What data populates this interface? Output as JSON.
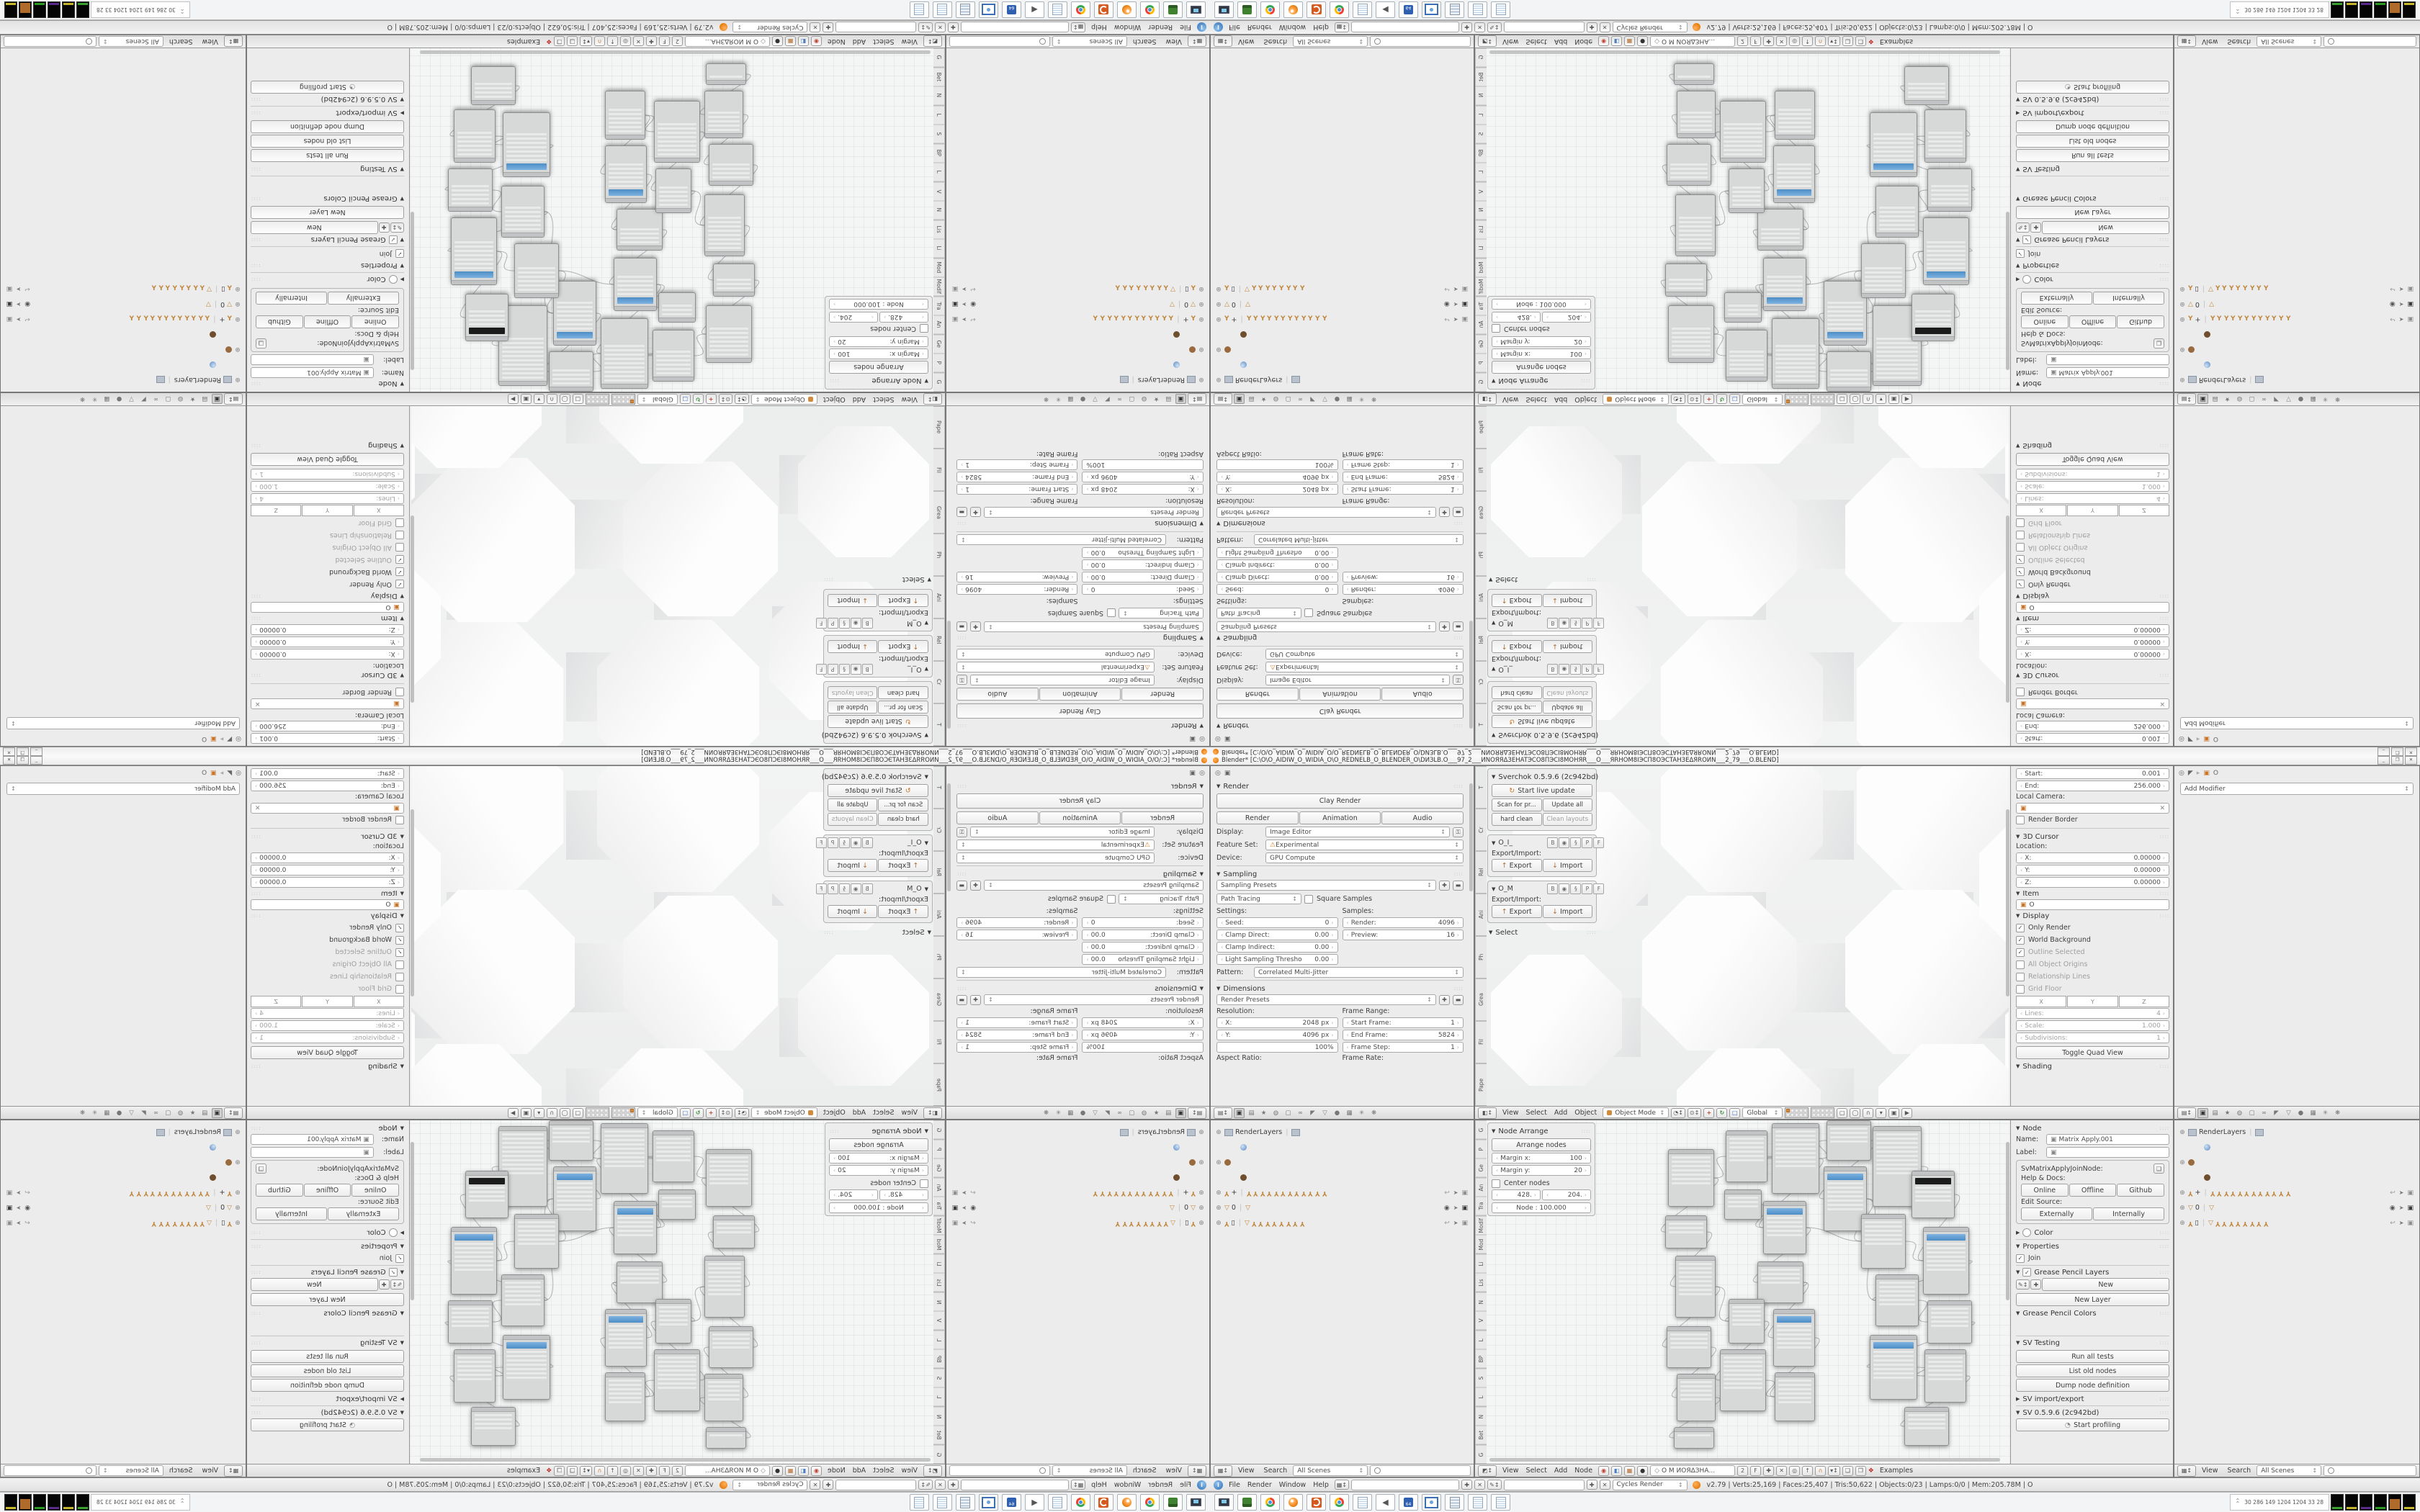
{
  "window": {
    "title": "Blender* [C:\\O\\O_AIDIW_O_WIDIA_O\\O_REDNELB_O_BLENDER_O\\DИЗLB.O___97_2___ИNOЯЯΔЗEHATЭCO8ΠЭCI8MOHЯR___O___ЯRHOM8IЭCΠ8OЭCTAHЗEΔЯROИN___2_79___O.BLEND]",
    "minimize": "_",
    "restore": "❐",
    "close": "✕"
  },
  "props_render": {
    "render_panel": "Render",
    "clay_button": "Clay Render",
    "render_btn": "Render",
    "animation_btn": "Animation",
    "audio_btn": "Audio",
    "display_label": "Display:",
    "display_value": "Image Editor",
    "feature_label": "Feature Set:",
    "feature_value": "Experimental",
    "device_label": "Device:",
    "device_value": "GPU Compute",
    "sampling_panel": "Sampling",
    "sampling_presets": "Sampling Presets",
    "integrator": "Path Tracing",
    "square_samples": "Square Samples",
    "settings_label": "Settings:",
    "samples_label": "Samples:",
    "seed_label": "Seed:",
    "seed_value": "0",
    "clamp_direct_label": "Clamp Direct:",
    "clamp_direct_value": "0.00",
    "clamp_indirect_label": "Clamp Indirect:",
    "clamp_indirect_value": "0.00",
    "light_thresh_label": "Light Sampling Thresho",
    "light_thresh_value": "0.00",
    "samples_render_label": "Render:",
    "samples_render_value": "4096",
    "samples_preview_label": "Preview:",
    "samples_preview_value": "16",
    "pattern_label": "Pattern:",
    "pattern_value": "Correlated Multi-Jitter",
    "dimensions_panel": "Dimensions",
    "render_presets": "Render Presets",
    "resolution_label": "Resolution:",
    "frame_range_label": "Frame Range:",
    "res_x_label": "X:",
    "res_x_value": "2048 px",
    "res_y_label": "Y:",
    "res_y_value": "4096 px",
    "res_pct": "100%",
    "frame_start_label": "Start Frame:",
    "frame_start_value": "1",
    "frame_end_label": "End Frame:",
    "frame_end_value": "5824",
    "frame_step_label": "Frame Step:",
    "frame_step_value": "1",
    "aspect_label": "Aspect Ratio:",
    "rate_label": "Frame Rate:"
  },
  "property_tabs": [
    {
      "name": "render-tab",
      "glyph": "▣",
      "active": true
    },
    {
      "name": "render-layers-tab",
      "glyph": "▤"
    },
    {
      "name": "scene-tab",
      "glyph": "★"
    },
    {
      "name": "world-tab",
      "glyph": "◍"
    },
    {
      "name": "object-tab",
      "glyph": "▢"
    },
    {
      "name": "constraints-tab",
      "glyph": "∞"
    },
    {
      "name": "modifiers-tab",
      "glyph": "◤"
    },
    {
      "name": "data-tab",
      "glyph": "▽"
    },
    {
      "name": "material-tab",
      "glyph": "●"
    },
    {
      "name": "texture-tab",
      "glyph": "▦"
    },
    {
      "name": "particles-tab",
      "glyph": "✳"
    },
    {
      "name": "physics-tab",
      "glyph": "❋"
    }
  ],
  "viewport": {
    "shelf_tabs": [
      "T",
      "Cr",
      "Rel",
      "Ani",
      "Ph",
      "Grea",
      "Fil",
      "Pape"
    ],
    "sverchok": {
      "title": "Sverchok 0.5.9.6 (2c942bd)",
      "start_live": "Start live update",
      "scan": "Scan for pr...",
      "update_all": "Update all",
      "hard_clean": "hard clean",
      "clean_layouts": "Clean layouts",
      "tree1": "O_I_",
      "tree2": "O_M",
      "row_buttons": [
        "B",
        "◉",
        "§",
        "P",
        "F"
      ],
      "export_import": "Export/Import:",
      "export_btn": "Export",
      "import_btn": "Import",
      "select_panel": "Select"
    },
    "npanel": {
      "start_label": "Start:",
      "start_value": "0.001",
      "end_label": "End:",
      "end_value": "256.000",
      "local_camera": "Local Camera:",
      "render_border": "Render Border",
      "cursor_panel": "3D Cursor",
      "location_label": "Location:",
      "x_label": "X:",
      "x_value": "0.00000",
      "y_label": "Y:",
      "y_value": "0.00000",
      "z_label": "Z:",
      "z_value": "0.00000",
      "item_panel": "Item",
      "item_name": "O",
      "display_panel": "Display",
      "checks": [
        {
          "label": "Only Render",
          "checked": true,
          "muted": false
        },
        {
          "label": "World Background",
          "checked": true,
          "muted": false
        },
        {
          "label": "Outline Selected",
          "checked": true,
          "muted": true
        },
        {
          "label": "All Object Origins",
          "checked": false,
          "muted": true
        },
        {
          "label": "Relationship Lines",
          "checked": false,
          "muted": true
        },
        {
          "label": "Grid Floor",
          "checked": false,
          "muted": true
        }
      ],
      "xyz": [
        "X",
        "Y",
        "Z"
      ],
      "lines_label": "Lines:",
      "lines_value": "4",
      "scale_label": "Scale:",
      "scale_value": "1.000",
      "subdiv_label": "Subdivisions:",
      "subdiv_value": "1",
      "toggle_quad": "Toggle Quad View",
      "shading_panel": "Shading"
    },
    "header": {
      "menus": [
        "View",
        "Select",
        "Add",
        "Object"
      ],
      "mode": "Object Mode",
      "orientation": "Global"
    }
  },
  "props_modifier": {
    "object_name": "O",
    "add_modifier": "Add Modifier"
  },
  "outliner": {
    "rows": [
      {
        "name": "renderlayers-row",
        "expand": true,
        "icon": "image",
        "label": "RenderLayers",
        "trail": [
          "image"
        ],
        "right": []
      },
      {
        "name": "world-row",
        "indent": 1,
        "icon": "world",
        "label": "",
        "trail": [],
        "right": []
      },
      {
        "name": "object-row",
        "expand": true,
        "icon": "bear",
        "label": "",
        "trail": [],
        "right": []
      },
      {
        "name": "object-data-row",
        "indent": 1,
        "icon": "bear2",
        "label": "",
        "trail": [],
        "right": []
      },
      {
        "name": "armature-plus-row",
        "expand": true,
        "icon": "arm",
        "label": "+",
        "trail": [
          "arm",
          "arm",
          "arm",
          "arm",
          "arm",
          "arm",
          "arm",
          "arm",
          "arm",
          "arm",
          "arm",
          "arm"
        ],
        "right": [
          "undo",
          "cursor",
          "cam"
        ]
      },
      {
        "name": "cone-zero-row",
        "expand": true,
        "icon": "cone",
        "label": "0",
        "trail": [
          "cone"
        ],
        "right": [
          "eye",
          "cursor",
          "camdark"
        ]
      },
      {
        "name": "armature-box-row",
        "expand": true,
        "icon": "arm",
        "label": "▯",
        "trail": [
          "cone",
          "arm",
          "arm",
          "arm",
          "arm",
          "arm",
          "arm",
          "arm",
          "arm"
        ],
        "right": [
          "undo",
          "cursor",
          "cam"
        ]
      }
    ],
    "header": {
      "view": "View",
      "search": "Search",
      "scenes": "All Scenes"
    }
  },
  "node_editor": {
    "shelf_tabs": [
      "G",
      "P",
      "Ge",
      "An",
      "Tra",
      "Modif",
      "Mod",
      "Li",
      "Lis",
      "N",
      "V",
      "L",
      "BP",
      "S",
      "L",
      "N",
      "Bet",
      "G"
    ],
    "arrange": {
      "panel_title": "Node Arrange",
      "arrange_btn": "Arrange nodes",
      "margin_x_label": "Margin x:",
      "margin_x_value": "100",
      "margin_y_label": "Margin y:",
      "margin_y_value": "20",
      "center_nodes": "Center nodes",
      "field_a": "428.",
      "field_b": "204.",
      "node_scale": "Node : 100.000"
    },
    "header": {
      "menus": [
        "View",
        "Select",
        "Add",
        "Node"
      ],
      "tree_name": "O M ИОЯΔЗНА...",
      "users": "2",
      "fake": "F",
      "examples": "Examples"
    },
    "nodes": [
      [
        268,
        40,
        64,
        80,
        0
      ],
      [
        264,
        132,
        58,
        46,
        0
      ],
      [
        278,
        188,
        56,
        86,
        0
      ],
      [
        266,
        286,
        62,
        58,
        0
      ],
      [
        280,
        352,
        54,
        66,
        0
      ],
      [
        276,
        426,
        56,
        30,
        0
      ],
      [
        348,
        14,
        58,
        72,
        0
      ],
      [
        346,
        96,
        52,
        42,
        0
      ],
      [
        412,
        4,
        66,
        98,
        0
      ],
      [
        400,
        112,
        60,
        74,
        1
      ],
      [
        392,
        196,
        64,
        58,
        0
      ],
      [
        414,
        262,
        58,
        80,
        1
      ],
      [
        352,
        248,
        50,
        62,
        0
      ],
      [
        340,
        318,
        64,
        86,
        0
      ],
      [
        416,
        350,
        56,
        68,
        0
      ],
      [
        488,
        0,
        62,
        56,
        0
      ],
      [
        484,
        64,
        60,
        90,
        1
      ],
      [
        552,
        8,
        68,
        112,
        0
      ],
      [
        536,
        130,
        62,
        76,
        0
      ],
      [
        606,
        70,
        60,
        66,
        2
      ],
      [
        622,
        148,
        64,
        94,
        1
      ],
      [
        556,
        214,
        60,
        72,
        0
      ],
      [
        628,
        250,
        62,
        60,
        0
      ],
      [
        548,
        298,
        66,
        90,
        1
      ],
      [
        624,
        318,
        58,
        74,
        0
      ],
      [
        596,
        398,
        62,
        54,
        0
      ]
    ],
    "links": [
      [
        0,
        1
      ],
      [
        1,
        2
      ],
      [
        2,
        3
      ],
      [
        3,
        4
      ],
      [
        4,
        5
      ],
      [
        0,
        6
      ],
      [
        6,
        8
      ],
      [
        7,
        9
      ],
      [
        8,
        9
      ],
      [
        9,
        10
      ],
      [
        10,
        11
      ],
      [
        10,
        12
      ],
      [
        11,
        14
      ],
      [
        12,
        13
      ],
      [
        13,
        14
      ],
      [
        8,
        15
      ],
      [
        15,
        16
      ],
      [
        16,
        18
      ],
      [
        17,
        19
      ],
      [
        18,
        20
      ],
      [
        19,
        20
      ],
      [
        20,
        21
      ],
      [
        21,
        22
      ],
      [
        22,
        23
      ],
      [
        23,
        24
      ],
      [
        24,
        25
      ],
      [
        16,
        21
      ],
      [
        9,
        18
      ],
      [
        2,
        12
      ]
    ]
  },
  "node_npanel": {
    "panel_title": "Node",
    "name_label": "Name:",
    "name_value": "Matrix Apply.001",
    "label_label": "Label:",
    "idname": "SvMatrixApplyJoinNode:",
    "help_docs": "Help & Docs:",
    "online": "Online",
    "offline": "Offline",
    "github": "Github",
    "edit_source": "Edit Source:",
    "externally": "Externally",
    "internally": "Internally",
    "color_panel": "Color",
    "properties_panel": "Properties",
    "join": "Join",
    "gp_layers_panel": "Grease Pencil Layers",
    "new_btn": "New",
    "new_layer_btn": "New Layer",
    "gp_colors_panel": "Grease Pencil Colors",
    "sv_testing_panel": "SV Testing",
    "run_tests": "Run all tests",
    "list_old": "List old nodes",
    "dump_def": "Dump node definition",
    "sv_import_panel": "SV import/export",
    "sv_version_panel": "SV 0.5.9.6 (2c942bd)",
    "profiling": "Start profiling"
  },
  "infobar": {
    "menus": [
      "File",
      "Render",
      "Window",
      "Help"
    ],
    "engine": "Cycles Render",
    "stats": "v2.79 | Verts:25,169 | Faces:25,407 | Tris:50,622 | Objects:0/23 | Lamps:0/0 | Mem:205.78M | O"
  },
  "taskbar": {
    "icons": [
      {
        "name": "screenshot-app-icon",
        "style": "pc"
      },
      {
        "name": "sdcard-app-icon",
        "style": "green"
      },
      {
        "name": "chrome-icon",
        "style": "chrome"
      },
      {
        "name": "blender-icon",
        "style": "blender"
      },
      {
        "name": "spiral-app-icon",
        "style": "spiral"
      },
      {
        "name": "chrome-icon-2",
        "style": "chrome"
      },
      {
        "name": "notepad-icon",
        "style": "note"
      },
      {
        "name": "speaker-icon",
        "style": "speaker"
      },
      {
        "name": "hwinfo64-icon",
        "style": "floppy"
      },
      {
        "name": "image-viewer-icon",
        "style": "frame"
      },
      {
        "name": "calculator-icon",
        "style": "calc"
      },
      {
        "name": "notepad-icon-2",
        "style": "note"
      },
      {
        "name": "notepad-icon-3",
        "style": "note"
      }
    ],
    "tray_numbers": "30   286   149  1204 1204   33    28",
    "tray_tiles": [
      "#39a02e",
      "#c2b42e",
      "#5a2a8a",
      "#2a9a22",
      "#b06a2a",
      "#c8b830"
    ]
  },
  "sculpture": {
    "octs": [
      [
        258,
        -50,
        225
      ],
      [
        530,
        -60,
        235
      ],
      [
        232,
        180,
        215
      ],
      [
        514,
        172,
        228
      ],
      [
        700,
        62,
        205
      ],
      [
        52,
        36,
        192
      ],
      [
        736,
        290,
        192
      ],
      [
        22,
        262,
        182
      ],
      [
        280,
        392,
        200
      ],
      [
        560,
        386,
        205
      ]
    ],
    "cubes": [
      [
        430,
        34,
        96
      ],
      [
        434,
        246,
        96
      ],
      [
        318,
        142,
        86
      ],
      [
        600,
        132,
        92
      ],
      [
        676,
        10,
        82
      ],
      [
        658,
        292,
        86
      ],
      [
        158,
        112,
        82
      ],
      [
        148,
        322,
        82
      ],
      [
        436,
        420,
        90
      ]
    ]
  },
  "colors": {
    "accent_blue": "#5b9fd6",
    "armature_orange": "#c0873f",
    "blender_orange": "#e87d0d"
  }
}
